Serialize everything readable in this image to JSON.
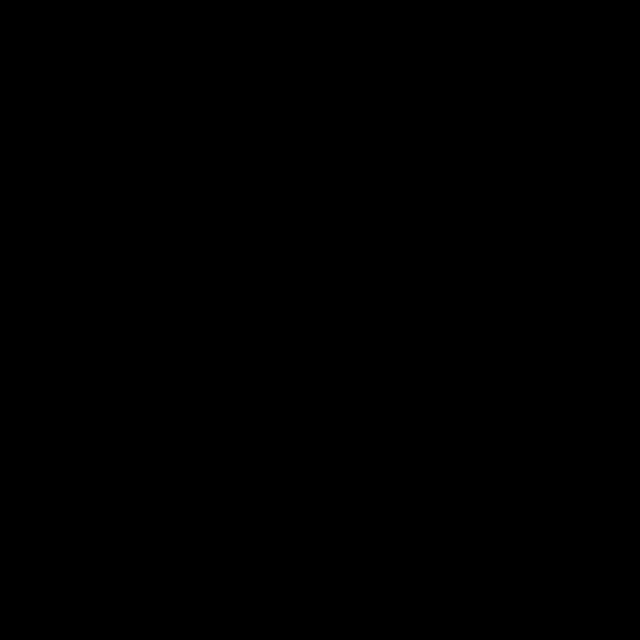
{
  "figure": {
    "width": 640,
    "height": 640,
    "background": "#000000"
  },
  "map": {
    "frame": {
      "x1": 50,
      "y1": 47,
      "x2": 591,
      "y2": 584,
      "bar_thickness": 7,
      "color": "#ffffff",
      "lon_bounds": [
        46,
        116,
        177,
        238,
        299,
        360,
        421,
        482,
        543,
        595
      ],
      "lat_bounds": [
        44,
        91,
        133,
        175,
        217,
        259,
        301,
        343,
        385,
        427,
        469,
        511,
        553,
        591
      ]
    },
    "axes": {
      "lon": {
        "labels": [
          "-70.50",
          "-70",
          "-69.50",
          "-69",
          "-68.50",
          "-68",
          "-67.50",
          "-67",
          "-66.50"
        ],
        "x": [
          55,
          116,
          177,
          238,
          299,
          360,
          421,
          482,
          543
        ],
        "top_y": 41,
        "bottom_y": 609
      },
      "lat": {
        "labels": [
          "41",
          "41.25",
          "41.50",
          "41.75",
          "42",
          "42.25",
          "42.50",
          "42.75",
          "43",
          "43.25",
          "43.50",
          "43.75"
        ],
        "y": [
          553,
          511,
          469,
          427,
          385,
          343,
          301,
          259,
          217,
          175,
          133,
          91
        ],
        "left_x": 33,
        "right_x": 607
      }
    },
    "land": {
      "color": "#666666",
      "maine": [
        [
          50,
          46
        ],
        [
          288,
          46
        ],
        [
          282,
          54
        ],
        [
          272,
          50
        ],
        [
          266,
          62
        ],
        [
          256,
          58
        ],
        [
          258,
          72
        ],
        [
          246,
          68
        ],
        [
          248,
          84
        ],
        [
          236,
          78
        ],
        [
          238,
          96
        ],
        [
          226,
          88
        ],
        [
          228,
          104
        ],
        [
          216,
          98
        ],
        [
          218,
          114
        ],
        [
          206,
          108
        ],
        [
          208,
          126
        ],
        [
          196,
          118
        ],
        [
          198,
          136
        ],
        [
          186,
          130
        ],
        [
          180,
          144
        ],
        [
          170,
          138
        ],
        [
          172,
          154
        ],
        [
          160,
          148
        ],
        [
          154,
          162
        ],
        [
          144,
          156
        ],
        [
          146,
          172
        ],
        [
          134,
          166
        ],
        [
          128,
          180
        ],
        [
          116,
          174
        ],
        [
          110,
          188
        ],
        [
          98,
          182
        ],
        [
          92,
          196
        ],
        [
          80,
          190
        ],
        [
          74,
          204
        ],
        [
          62,
          198
        ],
        [
          56,
          212
        ],
        [
          50,
          206
        ]
      ],
      "fjords": [
        [
          230,
          50,
          222,
          78
        ],
        [
          214,
          56,
          208,
          84
        ],
        [
          198,
          64,
          192,
          92
        ],
        [
          182,
          74,
          176,
          102
        ],
        [
          166,
          84,
          160,
          112
        ],
        [
          150,
          96,
          144,
          124
        ],
        [
          134,
          110,
          128,
          138
        ],
        [
          118,
          124,
          112,
          152
        ],
        [
          102,
          140,
          96,
          168
        ],
        [
          86,
          156,
          80,
          184
        ],
        [
          244,
          48,
          240,
          66
        ],
        [
          260,
          48,
          256,
          60
        ]
      ],
      "islands": [
        [
          162,
          96,
          5,
          3
        ],
        [
          178,
          106,
          4,
          3
        ],
        [
          192,
          86,
          5,
          3
        ],
        [
          206,
          96,
          4,
          2
        ],
        [
          236,
          56,
          6,
          3
        ],
        [
          250,
          63,
          4,
          2
        ],
        [
          226,
          76,
          4,
          2
        ],
        [
          152,
          116,
          4,
          2
        ],
        [
          136,
          131,
          4,
          2
        ],
        [
          121,
          146,
          4,
          2
        ],
        [
          258,
          52,
          3,
          2
        ],
        [
          268,
          60,
          3,
          2
        ]
      ],
      "cape_mainland": [
        [
          50,
          398
        ],
        [
          60,
          396
        ],
        [
          66,
          402
        ],
        [
          62,
          410
        ],
        [
          68,
          416
        ],
        [
          60,
          424
        ],
        [
          66,
          432
        ],
        [
          56,
          440
        ],
        [
          62,
          450
        ],
        [
          54,
          458
        ],
        [
          60,
          468
        ],
        [
          52,
          476
        ],
        [
          50,
          482
        ]
      ],
      "cape_arm": [
        [
          62,
          452
        ],
        [
          60,
          444
        ],
        [
          74,
          440
        ],
        [
          88,
          442
        ],
        [
          98,
          438
        ],
        [
          104,
          440
        ],
        [
          107,
          428
        ],
        [
          104,
          416
        ],
        [
          108,
          404
        ],
        [
          105,
          392
        ],
        [
          109,
          380
        ],
        [
          107,
          372
        ],
        [
          112,
          366
        ],
        [
          118,
          370
        ],
        [
          121,
          380
        ],
        [
          118,
          390
        ],
        [
          121,
          400
        ],
        [
          118,
          410
        ],
        [
          122,
          422
        ],
        [
          119,
          432
        ],
        [
          124,
          442
        ],
        [
          120,
          450
        ],
        [
          108,
          446
        ],
        [
          96,
          452
        ],
        [
          84,
          448
        ],
        [
          72,
          454
        ]
      ],
      "cape_hook": "M 112,370 C 106,356 90,358 86,370 C 83,381 92,391 102,387",
      "cape_wing": [
        [
          78,
          488
        ],
        [
          88,
          478
        ],
        [
          100,
          474
        ],
        [
          112,
          476
        ],
        [
          122,
          482
        ],
        [
          128,
          492
        ],
        [
          124,
          504
        ],
        [
          114,
          512
        ],
        [
          100,
          514
        ],
        [
          88,
          510
        ],
        [
          96,
          506
        ],
        [
          106,
          506
        ],
        [
          114,
          500
        ],
        [
          118,
          490
        ],
        [
          110,
          484
        ],
        [
          98,
          482
        ],
        [
          88,
          486
        ],
        [
          80,
          494
        ]
      ]
    },
    "lane": {
      "points": [
        [
          46,
          320
        ],
        [
          117,
          330
        ],
        [
          238,
          592
        ]
      ],
      "core_color": "#3a3a3a",
      "edge_color": "#ffffff"
    },
    "track": {
      "color": "#b8b8b8",
      "start_leg": [
        [
          142,
          434
        ],
        [
          152,
          436
        ],
        [
          162,
          431
        ],
        [
          172,
          435
        ],
        [
          181,
          429
        ],
        [
          190,
          424
        ],
        [
          198,
          418
        ],
        [
          206,
          411
        ],
        [
          214,
          403
        ],
        [
          222,
          394
        ],
        [
          229,
          385
        ],
        [
          236,
          375
        ],
        [
          242,
          365
        ],
        [
          247,
          356
        ]
      ],
      "loops": [
        {
          "a": [
            214,
            332
          ],
          "b": [
            243,
            253
          ],
          "w": 26
        },
        {
          "a": [
            272,
            344
          ],
          "b": [
            298,
            221
          ],
          "w": 30
        },
        {
          "a": [
            327,
            300
          ],
          "b": [
            350,
            197
          ],
          "w": 30
        },
        {
          "a": [
            382,
            298
          ],
          "b": [
            392,
            193
          ],
          "w": 28
        },
        {
          "a": [
            250,
            360
          ],
          "b": [
            291,
            441
          ],
          "w": 30
        },
        {
          "a": [
            308,
            352
          ],
          "b": [
            345,
            413
          ],
          "w": 26
        },
        {
          "a": [
            358,
            340
          ],
          "b": [
            385,
            378
          ],
          "w": 18
        },
        {
          "a": [
            400,
            305
          ],
          "b": [
            420,
            360
          ],
          "w": 46
        }
      ],
      "connectors": [
        [
          [
            385,
            297
          ],
          [
            395,
            292
          ],
          [
            405,
            290
          ],
          [
            414,
            289
          ],
          [
            420,
            288
          ]
        ],
        [
          [
            423,
            292
          ],
          [
            425,
            302
          ],
          [
            427,
            314
          ],
          [
            428,
            326
          ],
          [
            429,
            336
          ]
        ],
        [
          [
            234,
            316
          ],
          [
            239,
            323
          ],
          [
            243,
            328
          ],
          [
            246,
            331
          ]
        ]
      ],
      "knot": {
        "c": [
          421,
          289
        ],
        "r": 3
      }
    },
    "markers": {
      "start": {
        "x": 142,
        "y": 434,
        "r": 5,
        "color": "#00dd00"
      },
      "last": {
        "x": 250,
        "y": 335,
        "r": 5,
        "color": "#ee1100"
      },
      "selected": {
        "x": 246,
        "y": 330,
        "R": 9,
        "r2": 3.6,
        "color": "#ffe400"
      }
    }
  },
  "scale_bar": {
    "title": "Scale (km)",
    "tick_text": "10 0 1020304050",
    "x": 157,
    "y": 82,
    "width": 93,
    "height": 10,
    "segments": [
      "hatch",
      "black",
      "white",
      "black",
      "white",
      "black"
    ]
  },
  "legend": {
    "x_marker": 372,
    "x_text": 390,
    "row_y": [
      509,
      535,
      561
    ],
    "items": [
      {
        "marker": "circle",
        "color": "#00dd00",
        "label": "Start on 04/15/25 10:59"
      },
      {
        "marker": "circle",
        "color": "#ee1100",
        "label": "Last on 06/04/25 11:59"
      },
      {
        "marker": "star",
        "color": "#ffe400",
        "label": "Selected on 06/04/25 10:44"
      }
    ]
  }
}
